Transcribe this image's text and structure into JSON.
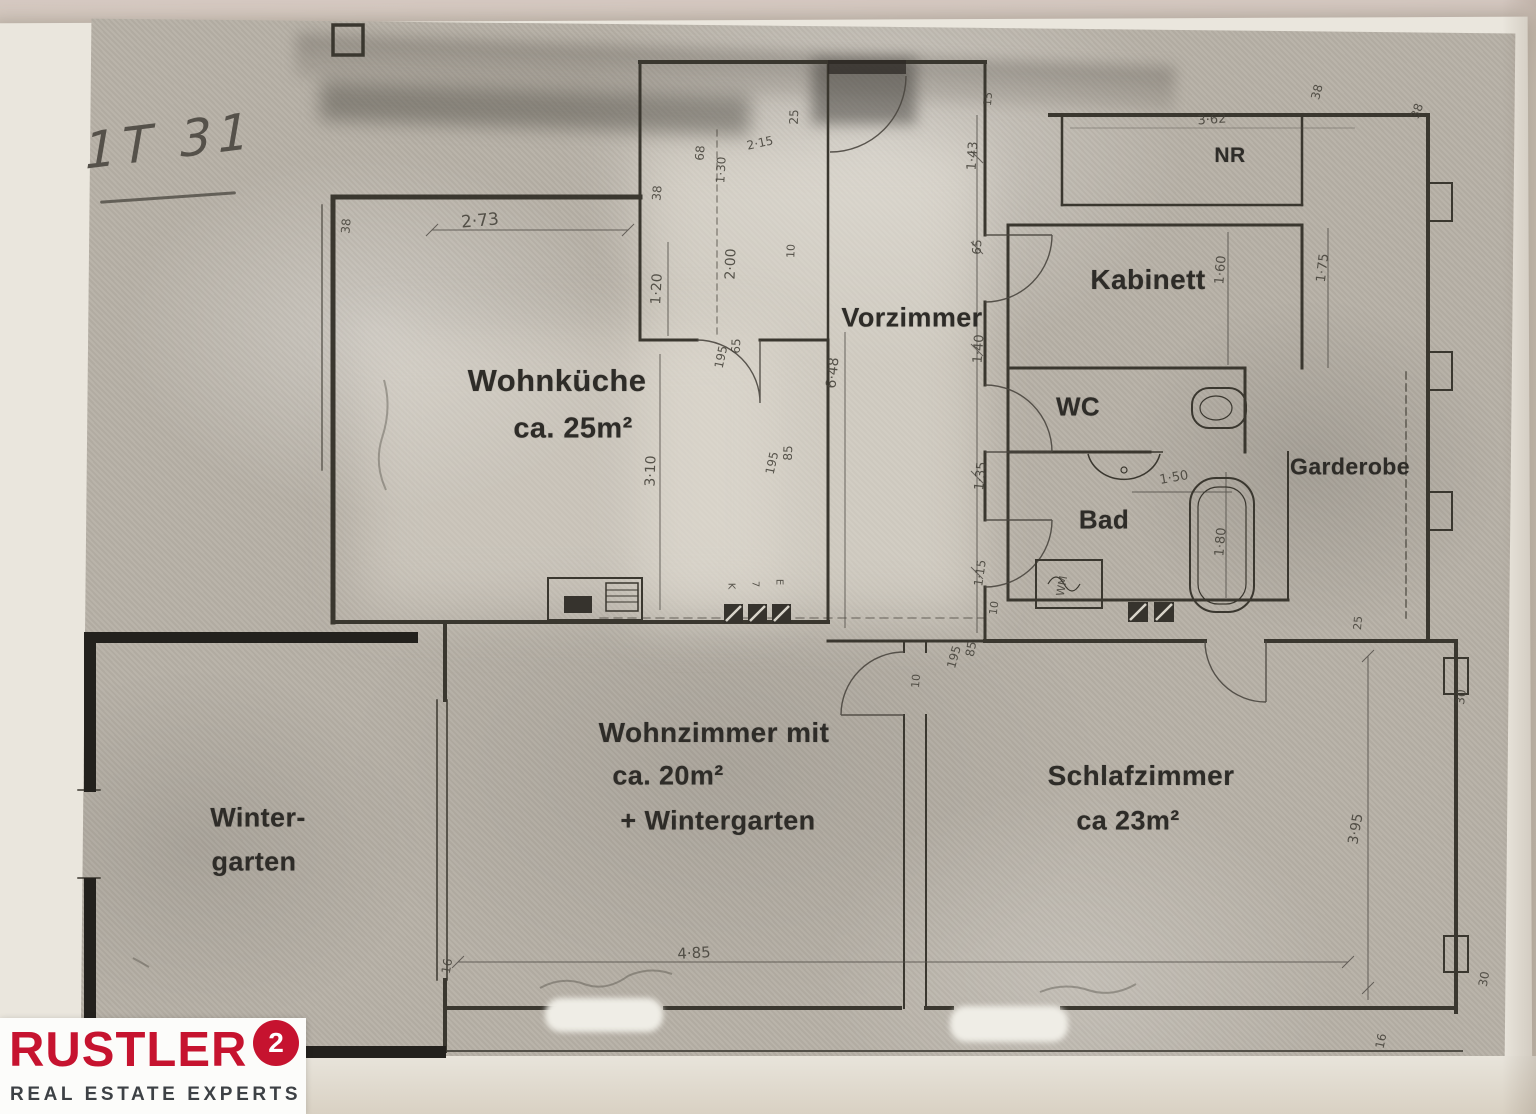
{
  "page": {
    "handwritten_note": "1T 31"
  },
  "rooms": [
    {
      "id": "wohnkueche",
      "label": "Wohnküche",
      "sublabel": "ca. 25m²"
    },
    {
      "id": "vorzimmer",
      "label": "Vorzimmer"
    },
    {
      "id": "nr",
      "label": "NR"
    },
    {
      "id": "kabinett",
      "label": "Kabinett"
    },
    {
      "id": "wc",
      "label": "WC"
    },
    {
      "id": "bad",
      "label": "Bad"
    },
    {
      "id": "garderobe",
      "label": "Garderobe"
    },
    {
      "id": "wohnzimmer",
      "label": "Wohnzimmer mit",
      "sublabel": "ca. 20m²",
      "sublabel2": "+ Wintergarten"
    },
    {
      "id": "schlafzimmer",
      "label": "Schlafzimmer",
      "sublabel": "ca 23m²"
    },
    {
      "id": "wintergarten",
      "label": "Winter-",
      "sublabel": "garten"
    }
  ],
  "dimensions": [
    {
      "t": "2·73",
      "x": 480,
      "y": 221,
      "r": -5,
      "s": 17
    },
    {
      "t": "38",
      "x": 346,
      "y": 226,
      "r": -85,
      "s": 12
    },
    {
      "t": "38",
      "x": 657,
      "y": 193,
      "r": -85,
      "s": 12
    },
    {
      "t": "68",
      "x": 700,
      "y": 153,
      "r": -85,
      "s": 12
    },
    {
      "t": "1·30",
      "x": 721,
      "y": 170,
      "r": -87,
      "s": 12
    },
    {
      "t": "2·15",
      "x": 760,
      "y": 143,
      "r": -12,
      "s": 12
    },
    {
      "t": "25",
      "x": 794,
      "y": 117,
      "r": -88,
      "s": 12
    },
    {
      "t": "1·20",
      "x": 657,
      "y": 289,
      "r": -87,
      "s": 14
    },
    {
      "t": "2·00",
      "x": 731,
      "y": 264,
      "r": -88,
      "s": 14
    },
    {
      "t": "10",
      "x": 791,
      "y": 251,
      "r": -88,
      "s": 11
    },
    {
      "t": "65",
      "x": 736,
      "y": 346,
      "r": -87,
      "s": 12
    },
    {
      "t": "195",
      "x": 721,
      "y": 357,
      "r": -78,
      "s": 12
    },
    {
      "t": "3·10",
      "x": 651,
      "y": 471,
      "r": -88,
      "s": 14
    },
    {
      "t": "85",
      "x": 788,
      "y": 453,
      "r": -88,
      "s": 12
    },
    {
      "t": "195",
      "x": 772,
      "y": 463,
      "r": -78,
      "s": 12
    },
    {
      "t": "6·48",
      "x": 833,
      "y": 373,
      "r": -84,
      "s": 14
    },
    {
      "t": "15",
      "x": 988,
      "y": 99,
      "r": -85,
      "s": 11
    },
    {
      "t": "1·43",
      "x": 973,
      "y": 156,
      "r": -86,
      "s": 13
    },
    {
      "t": "65",
      "x": 977,
      "y": 247,
      "r": -86,
      "s": 12
    },
    {
      "t": "1·40",
      "x": 979,
      "y": 349,
      "r": -86,
      "s": 13
    },
    {
      "t": "1·35",
      "x": 981,
      "y": 476,
      "r": -84,
      "s": 13
    },
    {
      "t": "1·15",
      "x": 980,
      "y": 573,
      "r": -82,
      "s": 12
    },
    {
      "t": "10",
      "x": 994,
      "y": 608,
      "r": -82,
      "s": 11
    },
    {
      "t": "85",
      "x": 971,
      "y": 649,
      "r": -80,
      "s": 12
    },
    {
      "t": "195",
      "x": 954,
      "y": 657,
      "r": -74,
      "s": 12
    },
    {
      "t": "10",
      "x": 916,
      "y": 681,
      "r": -85,
      "s": 11
    },
    {
      "t": "3·62",
      "x": 1212,
      "y": 120,
      "r": -4,
      "s": 13
    },
    {
      "t": "38",
      "x": 1317,
      "y": 92,
      "r": -75,
      "s": 12
    },
    {
      "t": "38",
      "x": 1417,
      "y": 111,
      "r": -70,
      "s": 12
    },
    {
      "t": "1·60",
      "x": 1221,
      "y": 270,
      "r": -85,
      "s": 13
    },
    {
      "t": "1·75",
      "x": 1323,
      "y": 268,
      "r": -83,
      "s": 13
    },
    {
      "t": "1·50",
      "x": 1174,
      "y": 478,
      "r": -10,
      "s": 13
    },
    {
      "t": "1·80",
      "x": 1221,
      "y": 542,
      "r": -85,
      "s": 13
    },
    {
      "t": "25",
      "x": 1358,
      "y": 623,
      "r": -85,
      "s": 11
    },
    {
      "t": "30",
      "x": 1461,
      "y": 697,
      "r": -82,
      "s": 12
    },
    {
      "t": "3·95",
      "x": 1356,
      "y": 829,
      "r": -80,
      "s": 14
    },
    {
      "t": "30",
      "x": 1484,
      "y": 979,
      "r": -80,
      "s": 12
    },
    {
      "t": "16",
      "x": 1381,
      "y": 1041,
      "r": -78,
      "s": 12
    },
    {
      "t": "4·85",
      "x": 694,
      "y": 953,
      "r": -3,
      "s": 15
    },
    {
      "t": "16",
      "x": 447,
      "y": 966,
      "r": -80,
      "s": 12
    },
    {
      "t": "K",
      "x": 731,
      "y": 586,
      "r": 90,
      "s": 10
    },
    {
      "t": "7",
      "x": 755,
      "y": 584,
      "r": 90,
      "s": 10
    },
    {
      "t": "E",
      "x": 779,
      "y": 582,
      "r": 90,
      "s": 10
    },
    {
      "t": "WM",
      "x": 1062,
      "y": 586,
      "r": -80,
      "s": 11
    }
  ],
  "logo": {
    "brand": "RUSTLER",
    "superscript": "2",
    "tagline": "REAL ESTATE EXPERTS",
    "brand_color": "#c6132f",
    "tagline_color": "#3d4145"
  }
}
